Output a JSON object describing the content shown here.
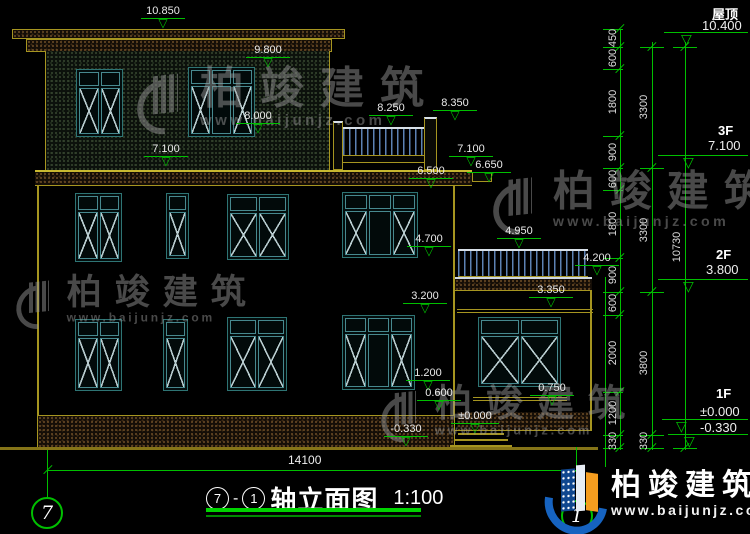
{
  "drawing": {
    "title": {
      "axis_start": "7",
      "axis_end": "1",
      "name": "轴立面图",
      "scale": "1:100"
    },
    "bottom_dim": "14100",
    "axis_bubbles": {
      "left": "7",
      "right": "1"
    },
    "elevation_marks": {
      "v10850": "10.850",
      "v9800": "9.800",
      "v8000": "8.000",
      "v7100L": "7.100",
      "v8250": "8.250",
      "v8350": "8.350",
      "v7100R": "7.100",
      "v6500": "6.500",
      "v6650": "6.650",
      "v4950": "4.950",
      "v4700": "4.700",
      "v4200": "4.200",
      "v3350": "3.350",
      "v3200": "3.200",
      "v1200": "1.200",
      "v0600": "0.600",
      "v0750": "0.750",
      "v0000": "±0.000",
      "vm0330": "-0.330"
    },
    "right_dims": {
      "chain_inner": [
        "450",
        "600",
        "1800",
        "900",
        "600",
        "1800",
        "900",
        "600",
        "2000",
        "1200",
        "330"
      ],
      "chain_middle": [
        "3300",
        "3300",
        "3800",
        "330"
      ],
      "chain_outer": [
        "10730"
      ],
      "floors": [
        {
          "label": "屋顶",
          "elevation": "10.400"
        },
        {
          "label": "3F",
          "elevation": "7.100"
        },
        {
          "label": "2F",
          "elevation": "3.800"
        },
        {
          "label": "1F",
          "elevation": "±0.000",
          "elevation_below": "-0.330"
        }
      ]
    }
  },
  "watermark": {
    "brand": "柏竣建筑",
    "url": "www.baijunjz.com"
  },
  "logo": {
    "brand": "柏竣建筑",
    "url": "www.baijunjz.com"
  },
  "colors": {
    "cad_green": "#00bf00",
    "cad_yellow": "#a69520",
    "window_teal": "#2e7474",
    "railing_blue": "#5d82b4",
    "logo_blue": "#1663c0",
    "logo_orange": "#f59d1f"
  }
}
